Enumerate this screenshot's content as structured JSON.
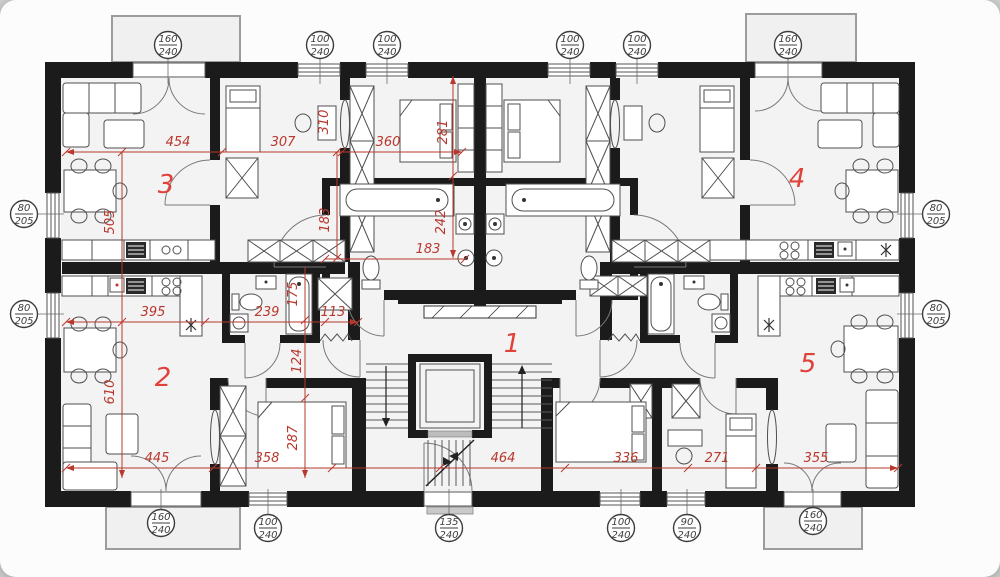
{
  "title": "apartment-building-floor-plan",
  "colors": {
    "wall": "#1b1b1b",
    "dim_red": "#b9382e",
    "room_red": "#e0423a",
    "label_text": "#3d3d3d",
    "furniture_stroke": "#4f4f4f",
    "room_fill": "#f3f3f3",
    "balcony_stroke": "#9c9c9c"
  },
  "plan": {
    "rooms": [
      {
        "n": "1",
        "x": 512,
        "y": 352
      },
      {
        "n": "2",
        "x": 163,
        "y": 386
      },
      {
        "n": "3",
        "x": 166,
        "y": 193
      },
      {
        "n": "4",
        "x": 797,
        "y": 187
      },
      {
        "n": "5",
        "x": 808,
        "y": 372
      }
    ],
    "dimensions": [
      {
        "t": "454",
        "x": 178,
        "y": 146,
        "rot": 0
      },
      {
        "t": "307",
        "x": 283,
        "y": 146,
        "rot": 0
      },
      {
        "t": "360",
        "x": 388,
        "y": 146,
        "rot": 0
      },
      {
        "t": "281",
        "x": 447,
        "y": 132,
        "rot": -90
      },
      {
        "t": "310",
        "x": 328,
        "y": 122,
        "rot": -90
      },
      {
        "t": "505",
        "x": 114,
        "y": 222,
        "rot": -90
      },
      {
        "t": "183",
        "x": 329,
        "y": 220,
        "rot": -90
      },
      {
        "t": "242",
        "x": 445,
        "y": 222,
        "rot": -90
      },
      {
        "t": "183",
        "x": 428,
        "y": 253,
        "rot": 0
      },
      {
        "t": "395",
        "x": 153,
        "y": 316,
        "rot": 0
      },
      {
        "t": "239",
        "x": 267,
        "y": 316,
        "rot": 0
      },
      {
        "t": "113",
        "x": 333,
        "y": 316,
        "rot": 0
      },
      {
        "t": "175",
        "x": 297,
        "y": 294,
        "rot": -90
      },
      {
        "t": "124",
        "x": 301,
        "y": 361,
        "rot": -90
      },
      {
        "t": "610",
        "x": 114,
        "y": 392,
        "rot": -90
      },
      {
        "t": "287",
        "x": 297,
        "y": 438,
        "rot": -90
      },
      {
        "t": "445",
        "x": 157,
        "y": 462,
        "rot": 0
      },
      {
        "t": "358",
        "x": 267,
        "y": 462,
        "rot": 0
      },
      {
        "t": "464",
        "x": 503,
        "y": 462,
        "rot": 0
      },
      {
        "t": "336",
        "x": 626,
        "y": 462,
        "rot": 0
      },
      {
        "t": "271",
        "x": 717,
        "y": 462,
        "rot": 0
      },
      {
        "t": "355",
        "x": 816,
        "y": 462,
        "rot": 0
      }
    ],
    "size_labels": [
      {
        "top": "160",
        "bot": "240",
        "x": 168,
        "y": 45,
        "side": "top"
      },
      {
        "top": "100",
        "bot": "240",
        "x": 320,
        "y": 45,
        "side": "top"
      },
      {
        "top": "100",
        "bot": "240",
        "x": 387,
        "y": 45,
        "side": "top"
      },
      {
        "top": "100",
        "bot": "240",
        "x": 570,
        "y": 45,
        "side": "top"
      },
      {
        "top": "100",
        "bot": "240",
        "x": 637,
        "y": 45,
        "side": "top"
      },
      {
        "top": "160",
        "bot": "240",
        "x": 788,
        "y": 45,
        "side": "top"
      },
      {
        "top": "80",
        "bot": "205",
        "x": 24,
        "y": 214,
        "side": "left"
      },
      {
        "top": "80",
        "bot": "205",
        "x": 24,
        "y": 314,
        "side": "left"
      },
      {
        "top": "80",
        "bot": "205",
        "x": 936,
        "y": 214,
        "side": "right"
      },
      {
        "top": "80",
        "bot": "205",
        "x": 936,
        "y": 314,
        "side": "right"
      },
      {
        "top": "160",
        "bot": "240",
        "x": 161,
        "y": 523,
        "side": "bottom"
      },
      {
        "top": "100",
        "bot": "240",
        "x": 268,
        "y": 528,
        "side": "bottom"
      },
      {
        "top": "135",
        "bot": "240",
        "x": 449,
        "y": 528,
        "side": "bottom"
      },
      {
        "top": "100",
        "bot": "240",
        "x": 621,
        "y": 528,
        "side": "bottom"
      },
      {
        "top": "90",
        "bot": "240",
        "x": 687,
        "y": 528,
        "side": "bottom"
      },
      {
        "top": "160",
        "bot": "240",
        "x": 813,
        "y": 521,
        "side": "bottom"
      }
    ]
  }
}
